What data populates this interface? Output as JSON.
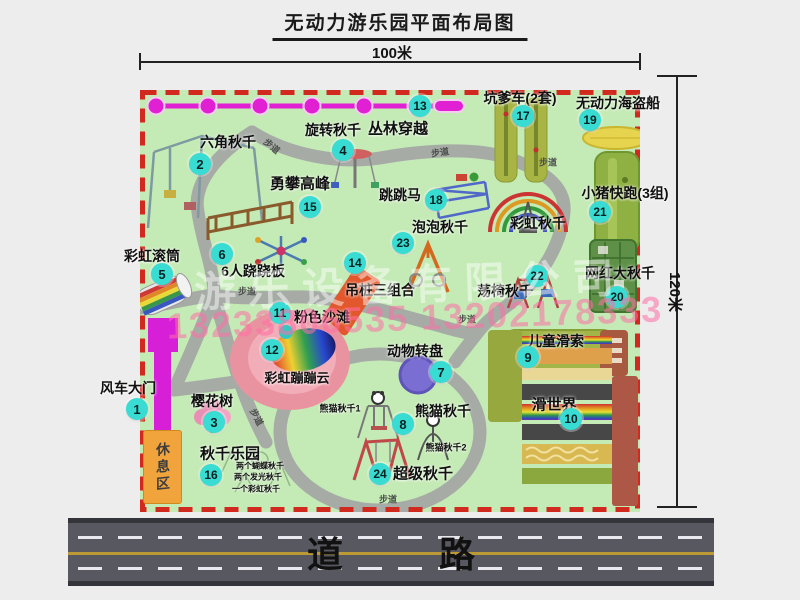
{
  "title": "无动力游乐园平面布局图",
  "dim_top": "100米",
  "dim_right": "120米",
  "road_label": "道　路",
  "rest_area_label": "休息区",
  "watermark": {
    "company": "游乐设备有限公司",
    "phone": "13233806535 13202178333"
  },
  "attractions": [
    {
      "num": "1",
      "name": "风车大门",
      "badge": [
        137,
        409
      ],
      "label": [
        128,
        388
      ]
    },
    {
      "num": "2",
      "name": "六角秋千",
      "badge": [
        200,
        164
      ],
      "label": [
        228,
        142
      ]
    },
    {
      "num": "3",
      "name": "樱花树",
      "badge": [
        214,
        422
      ],
      "label": [
        212,
        401
      ]
    },
    {
      "num": "4",
      "name": "旋转秋千",
      "badge": [
        343,
        150
      ],
      "label": [
        333,
        130
      ]
    },
    {
      "num": "5",
      "name": "彩虹滚筒",
      "badge": [
        162,
        274
      ],
      "label": [
        152,
        256
      ]
    },
    {
      "num": "6",
      "name": "6人跷跷板",
      "badge": [
        222,
        254
      ],
      "label": [
        253,
        271
      ]
    },
    {
      "num": "7",
      "name": "动物转盘",
      "badge": [
        441,
        372
      ],
      "label": [
        415,
        351
      ]
    },
    {
      "num": "8",
      "name": "熊猫秋千",
      "badge": [
        403,
        424
      ],
      "label": [
        443,
        411
      ]
    },
    {
      "num": "9",
      "name": "儿童滑索",
      "badge": [
        528,
        357
      ],
      "label": [
        556,
        341
      ]
    },
    {
      "num": "10",
      "name": "滑世界",
      "badge": [
        571,
        419
      ],
      "label": [
        554,
        404
      ],
      "fs": 15
    },
    {
      "num": "11",
      "name": "粉色沙滩",
      "badge": [
        280,
        313
      ],
      "label": [
        322,
        317
      ]
    },
    {
      "num": "12",
      "name": "彩虹蹦蹦云",
      "badge": [
        272,
        350
      ],
      "label": [
        297,
        377
      ],
      "fs": 13
    },
    {
      "num": "13",
      "name": "丛林穿越",
      "badge": [
        420,
        106
      ],
      "label": [
        398,
        128
      ],
      "fs": 15
    },
    {
      "num": "14",
      "name": "吊桩三组合",
      "badge": [
        355,
        263
      ],
      "label": [
        380,
        290
      ]
    },
    {
      "num": "15",
      "name": "勇攀高峰",
      "badge": [
        310,
        207
      ],
      "label": [
        300,
        183
      ],
      "fs": 15
    },
    {
      "num": "16",
      "name": "秋千乐园",
      "badge": [
        211,
        475
      ],
      "label": [
        230,
        453
      ],
      "fs": 15
    },
    {
      "num": "17",
      "name": "坑爹车(2套)",
      "badge": [
        523,
        116
      ],
      "label": [
        520,
        98
      ]
    },
    {
      "num": "18",
      "name": "跳跳马",
      "badge": [
        436,
        200
      ],
      "label": [
        400,
        195
      ]
    },
    {
      "num": "19",
      "name": "无动力海盗船",
      "badge": [
        590,
        120
      ],
      "label": [
        618,
        103
      ]
    },
    {
      "num": "20",
      "name": "网红大秋千",
      "badge": [
        617,
        297
      ],
      "label": [
        620,
        273
      ]
    },
    {
      "num": "21",
      "name": "小猪快跑(3组)",
      "badge": [
        600,
        212
      ],
      "label": [
        625,
        193
      ]
    },
    {
      "num": "22",
      "name": "荡椅秋千",
      "badge": [
        537,
        276
      ],
      "label": [
        505,
        291
      ]
    },
    {
      "num": "23",
      "name": "泡泡秋千",
      "badge": [
        403,
        243
      ],
      "label": [
        440,
        227
      ]
    },
    {
      "num": "24",
      "name": "超级秋千",
      "badge": [
        380,
        474
      ],
      "label": [
        423,
        473
      ],
      "fs": 15
    }
  ],
  "annotations": [
    {
      "text": "彩虹秋千",
      "x": 538,
      "y": 223,
      "fs": 14
    },
    {
      "text": "熊猫秋千1",
      "x": 340,
      "y": 408,
      "fs": 9
    },
    {
      "text": "熊猫秋千2",
      "x": 446,
      "y": 447,
      "fs": 9
    },
    {
      "text": "两个蝴蝶秋千",
      "x": 260,
      "y": 466,
      "fs": 8
    },
    {
      "text": "两个发光秋千",
      "x": 258,
      "y": 477,
      "fs": 8
    },
    {
      "text": "一个彩虹秋千",
      "x": 256,
      "y": 489,
      "fs": 8
    }
  ],
  "path_labels": [
    {
      "text": "步道",
      "x": 272,
      "y": 146,
      "rot": 40
    },
    {
      "text": "步道",
      "x": 440,
      "y": 152,
      "rot": -8
    },
    {
      "text": "步道",
      "x": 548,
      "y": 162,
      "rot": 0
    },
    {
      "text": "步道",
      "x": 247,
      "y": 291,
      "rot": 0
    },
    {
      "text": "步道",
      "x": 467,
      "y": 319,
      "rot": 0
    },
    {
      "text": "步道",
      "x": 257,
      "y": 417,
      "rot": 62
    },
    {
      "text": "步道",
      "x": 388,
      "y": 499,
      "rot": 0
    }
  ]
}
